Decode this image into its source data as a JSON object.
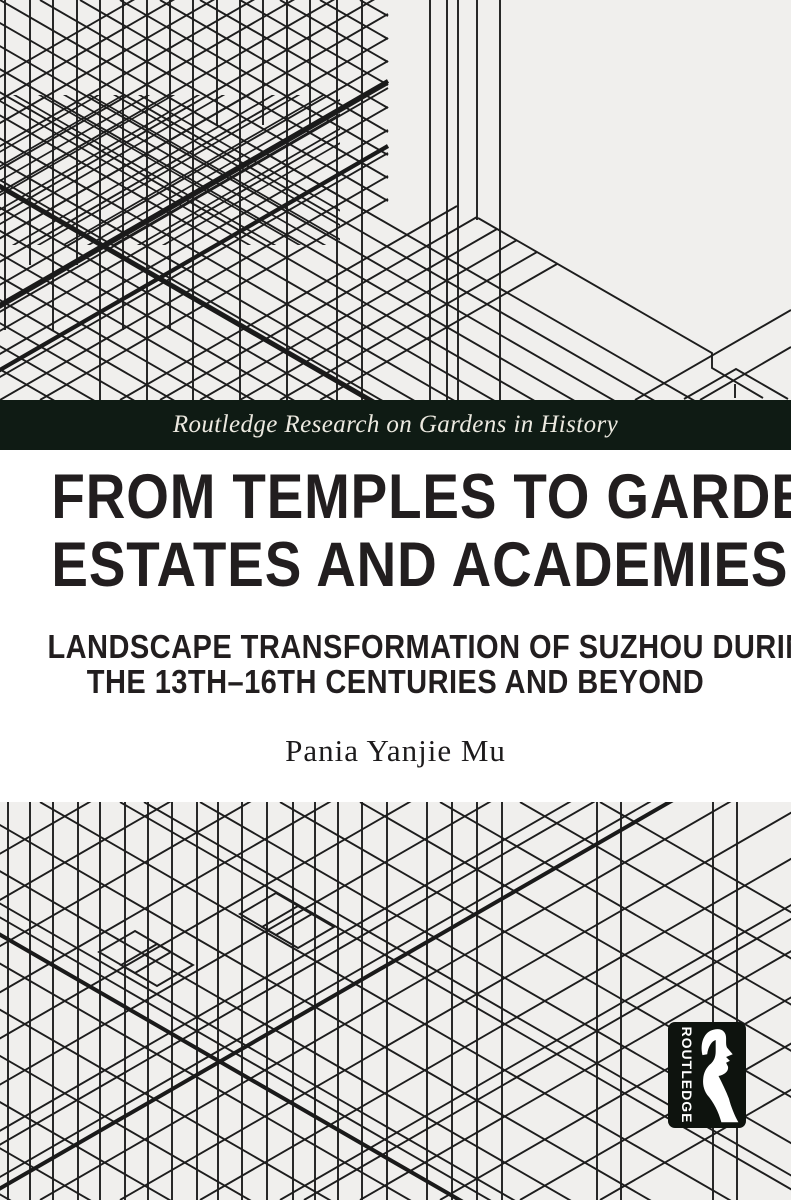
{
  "cover": {
    "series_band": {
      "label": "Routledge Research on Gardens in History"
    },
    "title": {
      "line1": "FROM TEMPLES TO GARDEN",
      "line2": "ESTATES AND ACADEMIES"
    },
    "subtitle": {
      "line1": "LANDSCAPE TRANSFORMATION OF SUZHOU DURING",
      "line2": "THE 13TH–16TH CENTURIES AND BEYOND"
    },
    "author": "Pania Yanjie Mu",
    "publisher_logo": {
      "name": "ROUTLEDGE",
      "icon": "routledge-head-icon"
    },
    "colors": {
      "pattern_bg": "#f0efed",
      "pattern_line": "#1d1d1d",
      "band_bg": "#0f1b14",
      "band_text": "#ece9e0",
      "title_text": "#221e1f",
      "section_bg": "#ffffff",
      "logo_bg": "#0e130e",
      "logo_text": "#ffffff"
    }
  }
}
